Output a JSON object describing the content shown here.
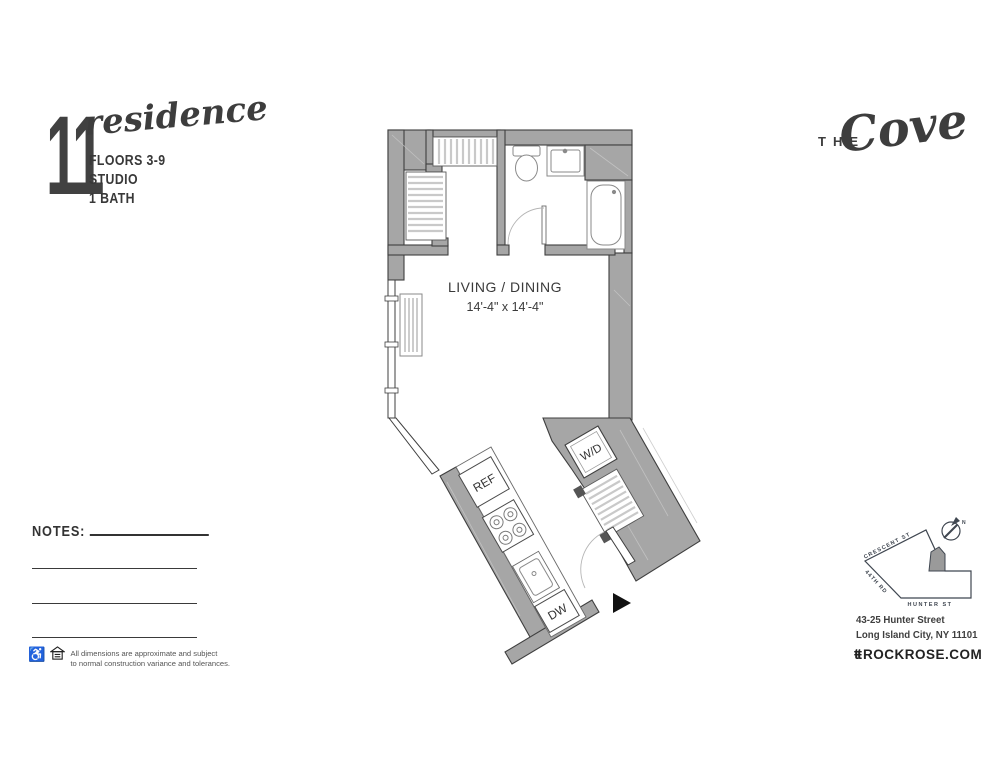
{
  "branding": {
    "residence_number": "11",
    "residence_script": "residence",
    "specs": [
      "FLOORS 3-9",
      "STUDIO",
      "1 BATH"
    ],
    "building_the": "THE",
    "building_name": "Cove"
  },
  "plan": {
    "living_label": "LIVING / DINING",
    "living_dims": "14'-4\" x 14'-4\"",
    "wd_label": "W/D",
    "ref_label": "REF",
    "dw_label": "DW"
  },
  "notes": {
    "label": "NOTES:"
  },
  "disclaimer": {
    "line1": "All dimensions are approximate and subject",
    "line2": "to normal construction variance and tolerances."
  },
  "map": {
    "street_top": "CRESCENT ST",
    "street_left": "44TH RD",
    "street_bottom": "HUNTER ST",
    "compass": "N",
    "address_line1": "43-25 Hunter Street",
    "address_line2": "Long Island City, NY 11101",
    "logo": "ŧŧ",
    "website": "ROCKROSE.COM"
  }
}
